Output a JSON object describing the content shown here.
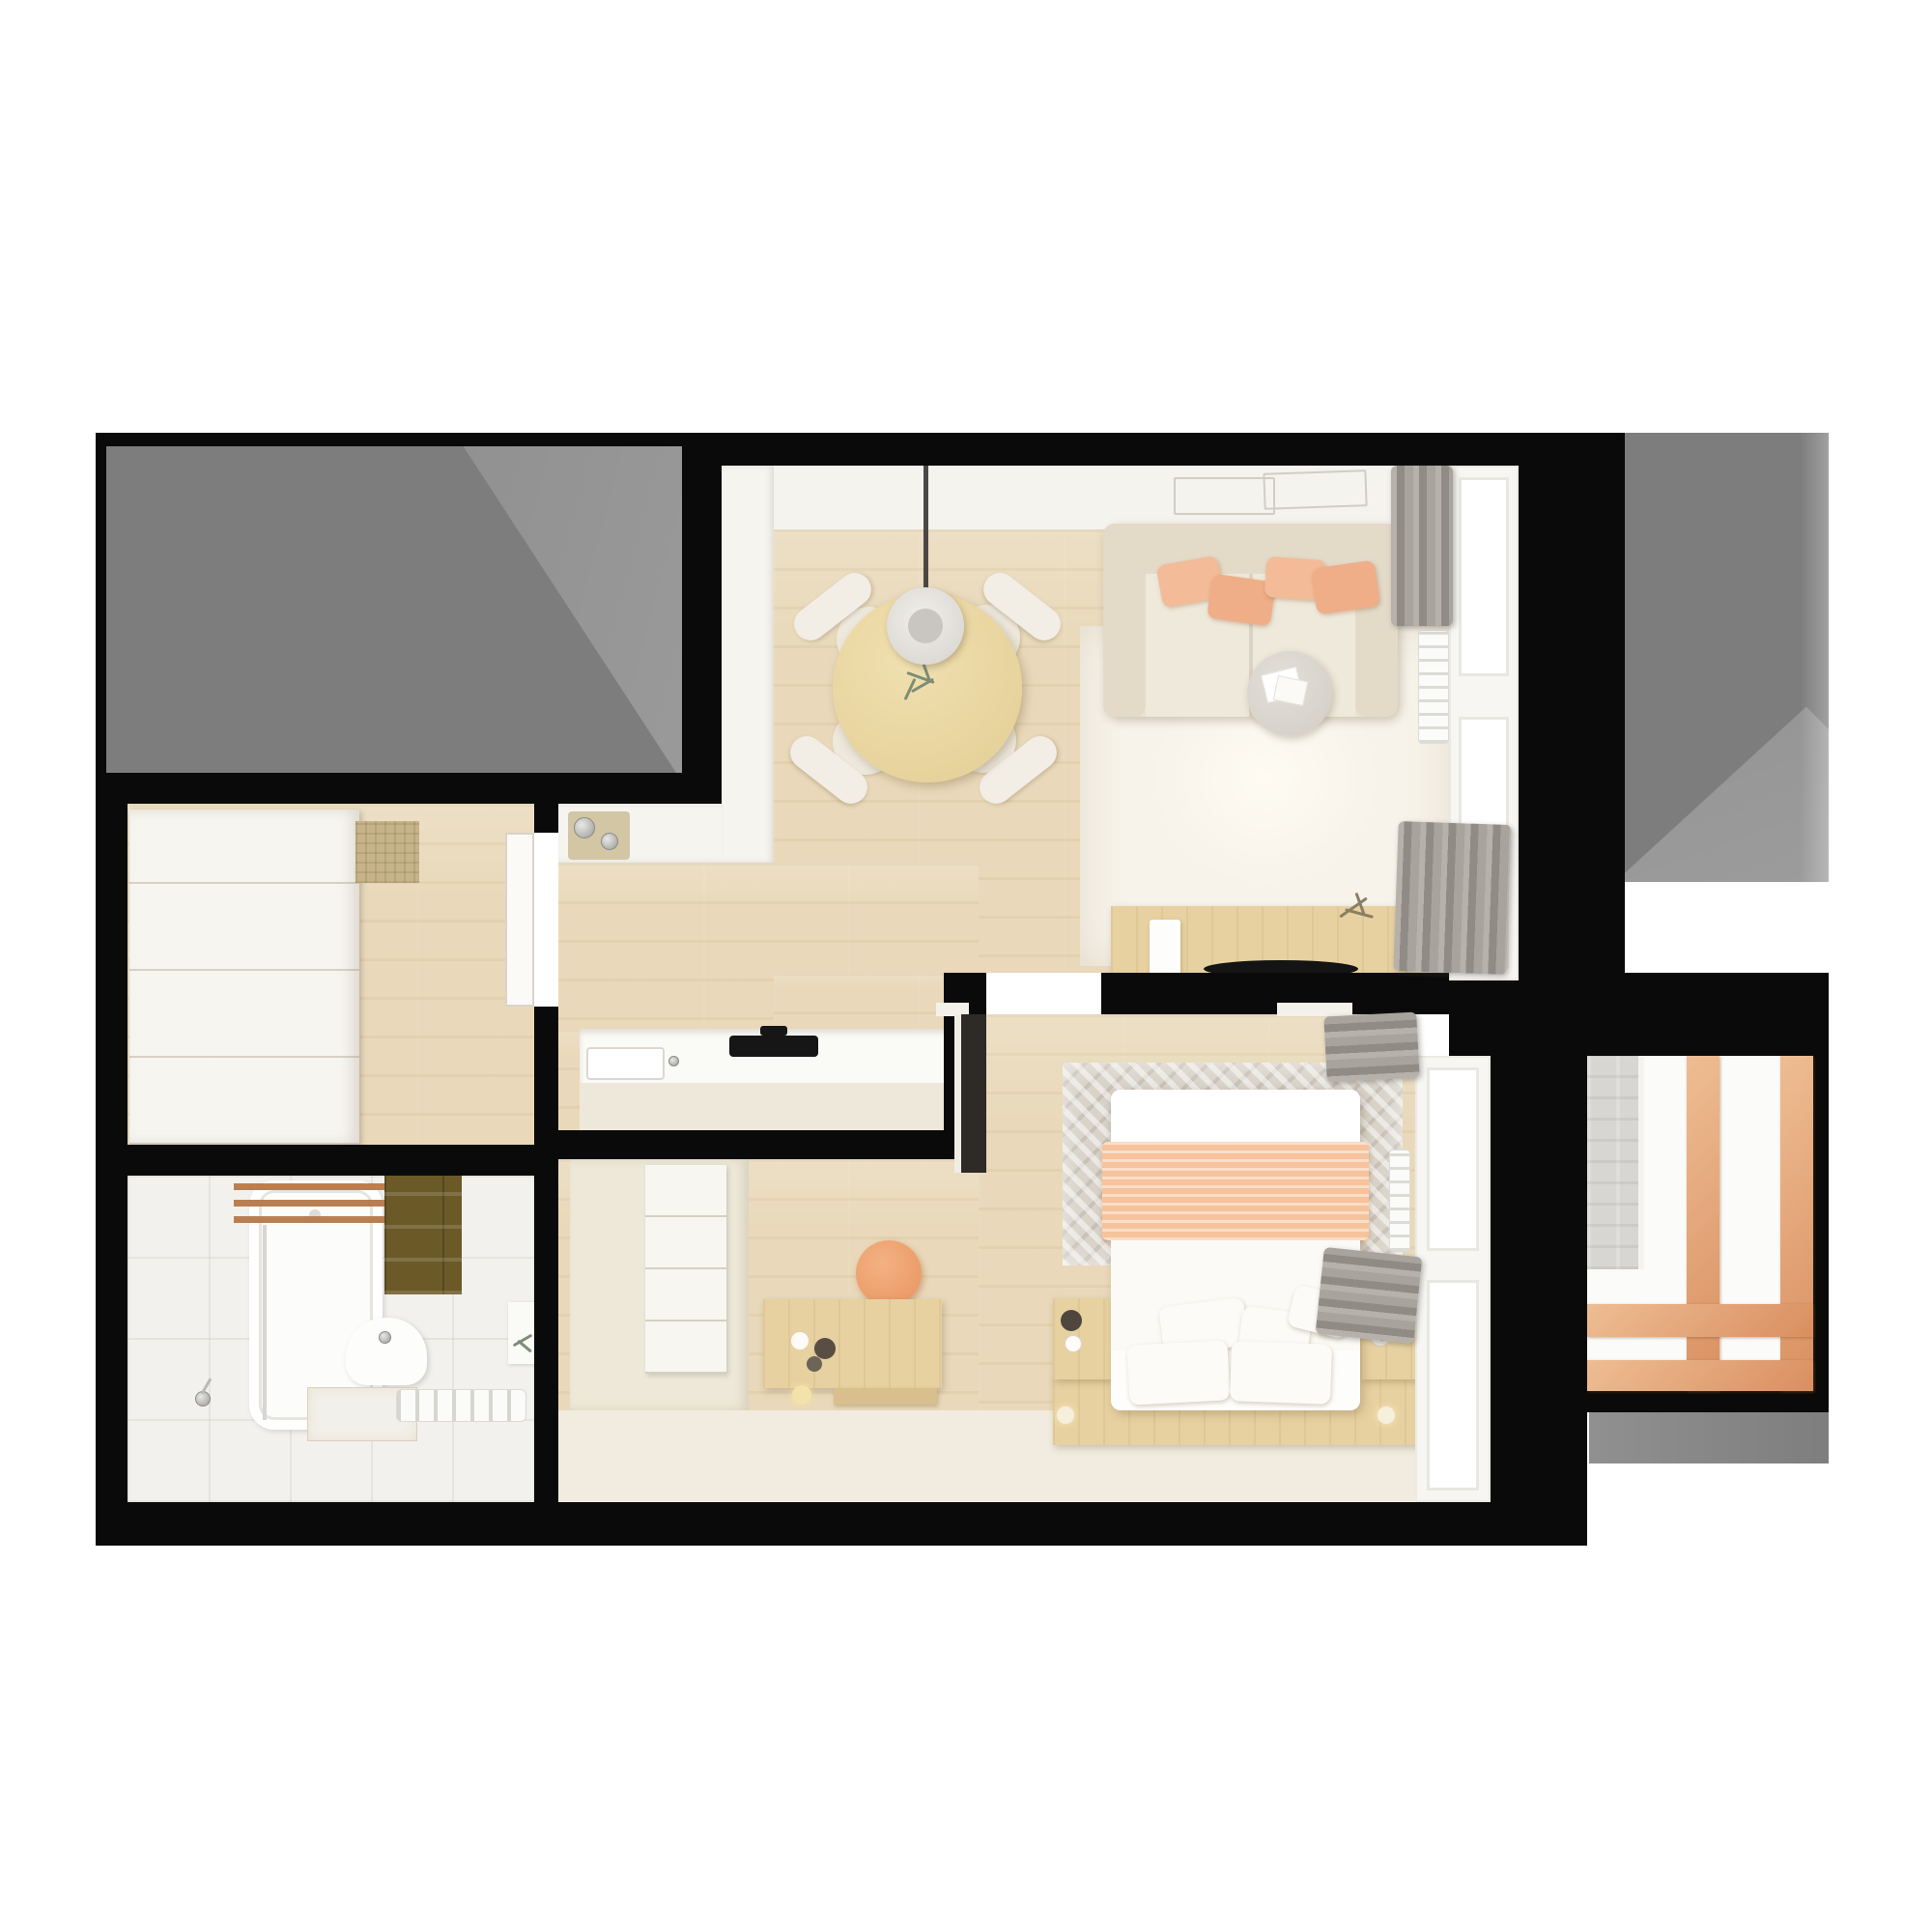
{
  "image": {
    "title": "Top-down 3D rendered floor plan of a one-bedroom apartment",
    "type": "floor-plan-render",
    "has_text": false
  },
  "palette": {
    "wall_black": "#0a0a0a",
    "adjacent_gray": "#7d7d7d",
    "wood_floor": "#e9d9ba",
    "furniture_wood": "#e7d1a1",
    "peach_accent": "#f2b491",
    "peach_blanket": "#f6c39c",
    "curtain_gray": "#a5a19a",
    "white_surface": "#f6f4ef",
    "olive_mat": "#6b5a28",
    "balcony_wood": "#e2a77e"
  },
  "rooms": [
    {
      "id": "living",
      "label": "Living and dining room",
      "items": [
        "round dining table",
        "four chairs",
        "pendant lamp",
        "plant centerpiece",
        "sofa with peach pillows",
        "area rug",
        "coffee table with magazines",
        "wall art frames",
        "TV console with dish and plant",
        "curtains",
        "radiator",
        "windows"
      ]
    },
    {
      "id": "kitchen",
      "label": "Kitchen",
      "items": [
        "white counter",
        "sink",
        "cooktop",
        "ceiling spotlight"
      ]
    },
    {
      "id": "hallway",
      "label": "Hallway",
      "items": [
        "white drawer dresser",
        "woven mat",
        "open white door"
      ]
    },
    {
      "id": "bathroom",
      "label": "Bathroom",
      "items": [
        "bathtub",
        "wooden slat shelf",
        "olive towel",
        "shower glass",
        "hand shower",
        "toilet",
        "vanity top",
        "towel radiator"
      ]
    },
    {
      "id": "bedroom",
      "label": "Bedroom",
      "items": [
        "double bed with peach blanket",
        "wood platform",
        "two nightstands",
        "distressed rug",
        "desk",
        "peach stool",
        "closet with shelves",
        "dark open door",
        "curtains",
        "radiator",
        "windows"
      ]
    },
    {
      "id": "balcony",
      "label": "Balcony",
      "items": [
        "wooden window frames",
        "concrete wall strip"
      ]
    },
    {
      "id": "gray_tl",
      "label": "Adjacent area upper left"
    },
    {
      "id": "gray_tr",
      "label": "Adjacent area upper right"
    },
    {
      "id": "gray_br",
      "label": "Adjacent area lower right"
    }
  ]
}
